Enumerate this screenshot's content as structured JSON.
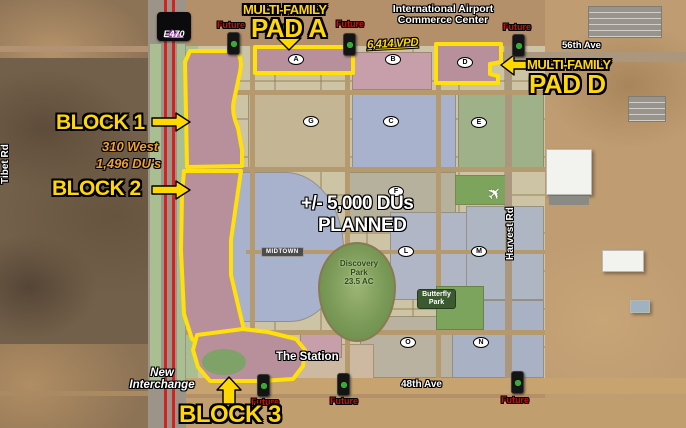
{
  "shield": {
    "label": "E470"
  },
  "roads": {
    "tibet": "Tibet Rd",
    "harvest": "Harvest Rd",
    "ave56": "56th Ave",
    "ave48": "48th Ave"
  },
  "header": {
    "commerce1": "International Airport",
    "commerce2": "Commerce Center",
    "vpd": "6,414 VPD"
  },
  "pad_a": {
    "tag": "MULTI-FAMILY",
    "name": "PAD A"
  },
  "pad_d": {
    "tag": "MULTI-FAMILY",
    "name": "PAD D"
  },
  "block1": {
    "label": "BLOCK 1",
    "project": "310 West",
    "units": "1,496 DU's"
  },
  "block2": {
    "label": "BLOCK 2"
  },
  "block3": {
    "label": "BLOCK 3"
  },
  "planned": {
    "line1": "+/- 5,000 DUs",
    "line2": "PLANNED"
  },
  "places": {
    "midtown": "MIDTOWN",
    "discovery1": "Discovery",
    "discovery2": "Park",
    "discovery3": "23.5 AC",
    "butterfly1": "Butterfly",
    "butterfly2": "Park",
    "station": "The Station",
    "interchange1": "New",
    "interchange2": "Interchange"
  },
  "signals": {
    "future": "Future"
  },
  "parcels": {
    "a": "A",
    "b": "B",
    "c": "C",
    "d": "D",
    "e": "E",
    "f": "F",
    "g": "G",
    "l": "L",
    "m": "M",
    "n": "N",
    "o": "O"
  },
  "colors": {
    "accent_yellow": "#ffd60a",
    "future_red": "#c81414",
    "block_fill": "#b8909b",
    "highway_red": "#d42222"
  }
}
